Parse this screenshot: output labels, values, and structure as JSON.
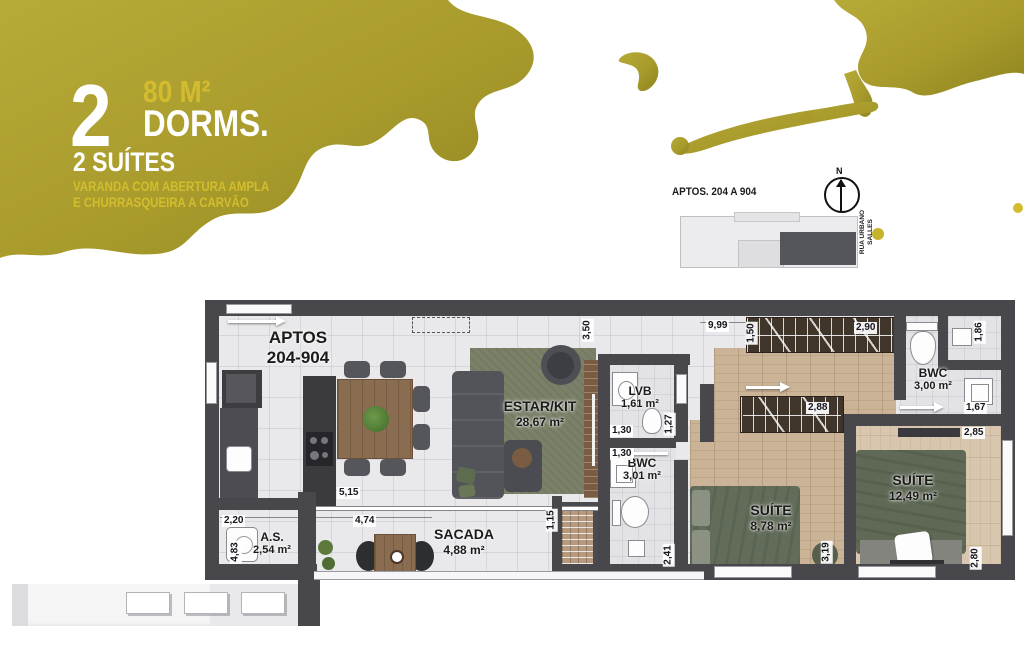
{
  "header": {
    "number": "2",
    "area": "80 M²",
    "dorms_label": "DORMS.",
    "suites_label": "2 SUÍTES",
    "feature_line1": "VARANDA COM ABERTURA AMPLA",
    "feature_line2": "E CHURRASQUEIRA A CARVÃO"
  },
  "keyplan": {
    "title": "APTOS. 204 A 904",
    "north_label": "N",
    "street": "RUA URBANO SALLES"
  },
  "plan": {
    "unit_line1": "APTOS",
    "unit_line2": "204-904",
    "rooms": {
      "estar": {
        "name": "ESTAR/KIT",
        "area": "28,67 m²"
      },
      "lvb": {
        "name": "LVB",
        "area": "1,61 m²"
      },
      "bwc1": {
        "name": "BWC",
        "area": "3,01 m²"
      },
      "suite1": {
        "name": "SUÍTE",
        "area": "8,78 m²"
      },
      "suite2": {
        "name": "SUÍTE",
        "area": "12,49 m²"
      },
      "bwc2": {
        "name": "BWC",
        "area": "3,00 m²"
      },
      "as": {
        "name": "A.S.",
        "area": "2,54 m²"
      },
      "sacada": {
        "name": "SACADA",
        "area": "4,88 m²"
      }
    },
    "dims": {
      "d220": "2,20",
      "d515": "5,15",
      "d474": "4,74",
      "d483": "4,83",
      "d350": "3,50",
      "d999": "9,99",
      "d150": "1,50",
      "d290": "2,90",
      "d186": "1,86",
      "d167": "1,67",
      "d285": "2,85",
      "d288": "2,88",
      "d130a": "1,30",
      "d127": "1,27",
      "d130b": "1,30",
      "d115": "1,15",
      "d241": "2,41",
      "d319": "3,19",
      "d280": "2,80"
    }
  },
  "colors": {
    "splash": "#a89b2c",
    "splash_light": "#b6aa38",
    "splash_dark": "#8e841f",
    "accent_gold": "#d3bd2e",
    "wall": "#47474c",
    "wood": "#cab396",
    "rug_green": "#7a8168",
    "tile": "#e9e9ec"
  }
}
